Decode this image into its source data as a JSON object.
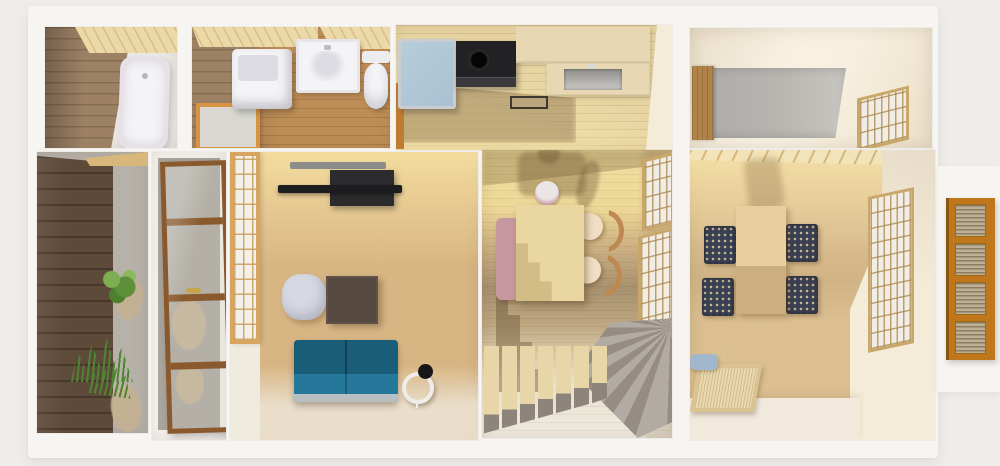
{
  "scene": {
    "type": "3d-rendered-floor-plan",
    "view": "top-down dollhouse cutaway of a Japanese-style house",
    "rooms": [
      {
        "name": "Bathroom",
        "items": [
          "bathtub",
          "wood plank wall",
          "wood ceiling strip"
        ]
      },
      {
        "name": "Washroom",
        "items": [
          "washing machine",
          "vanity sink",
          "toilet",
          "orange framed frosted window"
        ]
      },
      {
        "name": "Kitchen",
        "items": [
          "refrigerator",
          "black stove",
          "cream counter",
          "inset sink",
          "floor tray"
        ]
      },
      {
        "name": "Utility room",
        "items": [
          "wood door",
          "gray concrete floor",
          "lattice blind window"
        ]
      },
      {
        "name": "Entrance garden",
        "items": [
          "dark wood fence",
          "gravel bed",
          "shrub",
          "grass tufts",
          "stepping stones"
        ]
      },
      {
        "name": "Entryway",
        "items": [
          "wood framed glass door",
          "gravel floor",
          "stepping stones"
        ]
      },
      {
        "name": "Living room",
        "items": [
          "shoji screen",
          "wall mounted TV",
          "media console",
          "gray pouf",
          "dark coffee table",
          "teal sofa",
          "ring floor lamp"
        ]
      },
      {
        "name": "Dining room",
        "items": [
          "pendant lamp",
          "pink bench",
          "dining table",
          "two wood chairs",
          "L-shaped staircase with winder",
          "lattice windows"
        ]
      },
      {
        "name": "Tatami lounge",
        "items": [
          "low table",
          "four patterned floor cushions",
          "woven bench",
          "blue cushion",
          "lattice window",
          "rafter ceiling strip"
        ]
      },
      {
        "name": "Exterior",
        "items": [
          "orange louvered entry door"
        ]
      }
    ]
  },
  "colors": {
    "page_bg": "#efedea",
    "wall": "#f7f5f2",
    "wall_shade": "#e6e2db",
    "ceiling_wood": "#ecd9a8",
    "bath_wall": "#9d8165",
    "bath_floor": "#ebe8e4",
    "fixture_white": "#f4f3f5",
    "tub_tint": "#e7e1e7",
    "washroom_floor": "#bf8e57",
    "window_orange": "#d89441",
    "frosted_glass": "#d8d7d1",
    "kitchen_floor": "#e9d5a2",
    "fridge_blue": "#a9c1d2",
    "steel_trim": "#c9ccd0",
    "appliance_black": "#222225",
    "counter_cream": "#e8d7b3",
    "sink_gray": "#9d9c98",
    "utility_floor": "#b8b4b0",
    "cream_wall": "#f4ebd9",
    "door_wood": "#b18348",
    "deck_brown": "#5e4a39",
    "gravel": "#b6b1a9",
    "gravel_dark": "#a9a49c",
    "plant_green": "#6a9c42",
    "grass_green": "#4f8433",
    "stone_tan": "#c5b193",
    "entry_door_wood": "#8a592d",
    "living_floor": "#d8b684",
    "floor_sun": "#f1dea7",
    "floor_pale": "#eae4d8",
    "shoji_frame": "#d8a45f",
    "shoji_pane": "#f3f0e9",
    "tv_black": "#1d1d1f",
    "tv_gray": "#8c8c88",
    "console_dark": "#2c2c2e",
    "pouf_gray": "#d6d9e1",
    "coffee_table": "#564a40",
    "sofa_teal": "#1f6b88",
    "sofa_teal_dark": "#1a5d79",
    "sofa_seat": "#26789a",
    "sofa_base": "#b8bfc3",
    "lamp_white": "#efede9",
    "lamp_black": "#161619",
    "dining_floor": "#ccb082",
    "dining_sun": "#f2e2a3",
    "shadow_brown": "#6d573a",
    "bench_pink": "#c7989f",
    "table_tan": "#e9d6a0",
    "chair_seat": "#f1dfc5",
    "chair_wood": "#be8950",
    "pendant_white": "#ece5e6",
    "pendant_pink": "#c9a2ab",
    "stair_tread": "#e8d6a8",
    "stair_riser": "#8d857b",
    "stair_winder": "#a49b91",
    "tatami_floor": "#dbbf90",
    "cushion_dark": "#3a4053",
    "cushion_dot": "#cec3a0",
    "tatami_table": "#e8cf9d",
    "bench_wood": "#dbc291",
    "cushion_blue": "#a2b7cc",
    "lattice_tan": "#c8a769",
    "lattice_pane": "#f1ece4",
    "louver_orange": "#c0761a",
    "louver_slat": "#beb097"
  }
}
